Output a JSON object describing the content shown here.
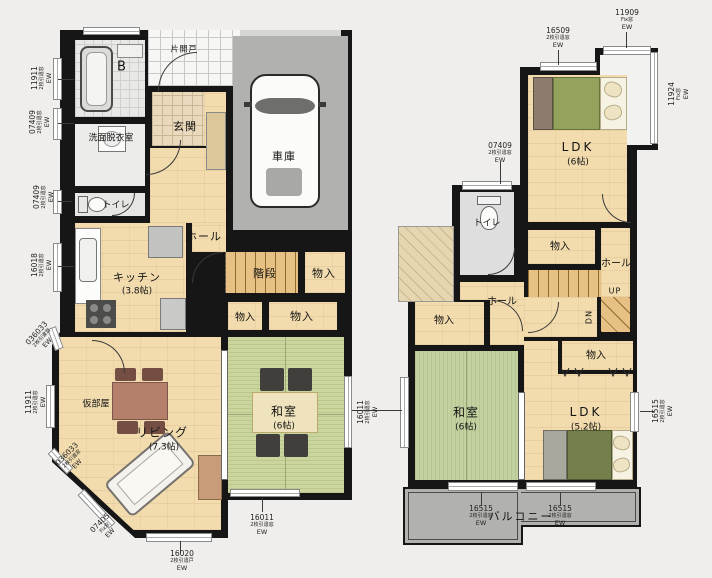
{
  "first_floor": {
    "rooms": {
      "bath": "B",
      "washroom": "洗面脱衣室",
      "toilet": "トイレ",
      "kitchen": "キッチン",
      "kitchen_size": "(3.8帖)",
      "entrance": "玄関",
      "entrance_door_note": "片開戸",
      "garage": "車庫",
      "hall": "ホール",
      "up": "UP",
      "stairs": "階段",
      "storage_a": "物入",
      "storage_b": "物入",
      "storage_c": "物入",
      "washitsu": "和室",
      "washitsu_size": "(6帖)",
      "living": "リビング",
      "living_size": "(7.3帖)",
      "spare_room": "仮部屋"
    },
    "dimensions": [
      {
        "code": "11911",
        "type": "2枚引違窓",
        "sash": "EW"
      },
      {
        "code": "07409",
        "type": "2枚引違窓",
        "sash": "EW"
      },
      {
        "code": "07409",
        "type": "2枚引違窓",
        "sash": "EW"
      },
      {
        "code": "16018",
        "type": "2枚引違窓",
        "sash": "EW"
      },
      {
        "code": "036033",
        "type": "2枚引違窓",
        "sash": "EW"
      },
      {
        "code": "11911",
        "type": "2枚引違窓",
        "sash": "EW"
      },
      {
        "code": "036033",
        "type": "2枚引違窓",
        "sash": "EW"
      },
      {
        "code": "07405",
        "type": "Fix窓",
        "sash": "EW"
      },
      {
        "code": "16020",
        "type": "2枚引違戸",
        "sash": "EW"
      },
      {
        "code": "16011",
        "type": "2枚引違窓",
        "sash": "EW"
      },
      {
        "code": "16011",
        "type": "2枚引違窓",
        "sash": "EW"
      }
    ]
  },
  "second_floor": {
    "rooms": {
      "ldk_a": "LDK",
      "ldk_a_size": "(6帖)",
      "toilet": "トイレ",
      "storage_a": "物入",
      "hall_a": "ホール",
      "hall_b": "ホール",
      "up": "UP",
      "down": "DN",
      "storage_b": "物入",
      "storage_c": "物入",
      "washitsu": "和室",
      "washitsu_size": "(6帖)",
      "ldk_b": "LDK",
      "ldk_b_size": "(5.2帖)",
      "balcony": "バルコニー"
    },
    "dimensions": [
      {
        "code": "16509",
        "type": "2枚引違窓",
        "sash": "EW"
      },
      {
        "code": "11909",
        "type": "Fix窓",
        "sash": "EW"
      },
      {
        "code": "11924",
        "type": "Fix窓",
        "sash": "EW"
      },
      {
        "code": "07409",
        "type": "2枚引違窓",
        "sash": "EW"
      },
      {
        "code": "16515",
        "type": "2枚引違窓",
        "sash": "EW"
      },
      {
        "code": "16515",
        "type": "2枚引違窓",
        "sash": "EW"
      },
      {
        "code": "16515",
        "type": "2枚引違窓",
        "sash": "EW"
      }
    ]
  },
  "colors": {
    "wall": "#161616",
    "wood_floor": "#f2dcae",
    "tatami": "#cbd59e",
    "garage_floor": "#b1b1af",
    "balcony_floor": "#b1b1af"
  }
}
